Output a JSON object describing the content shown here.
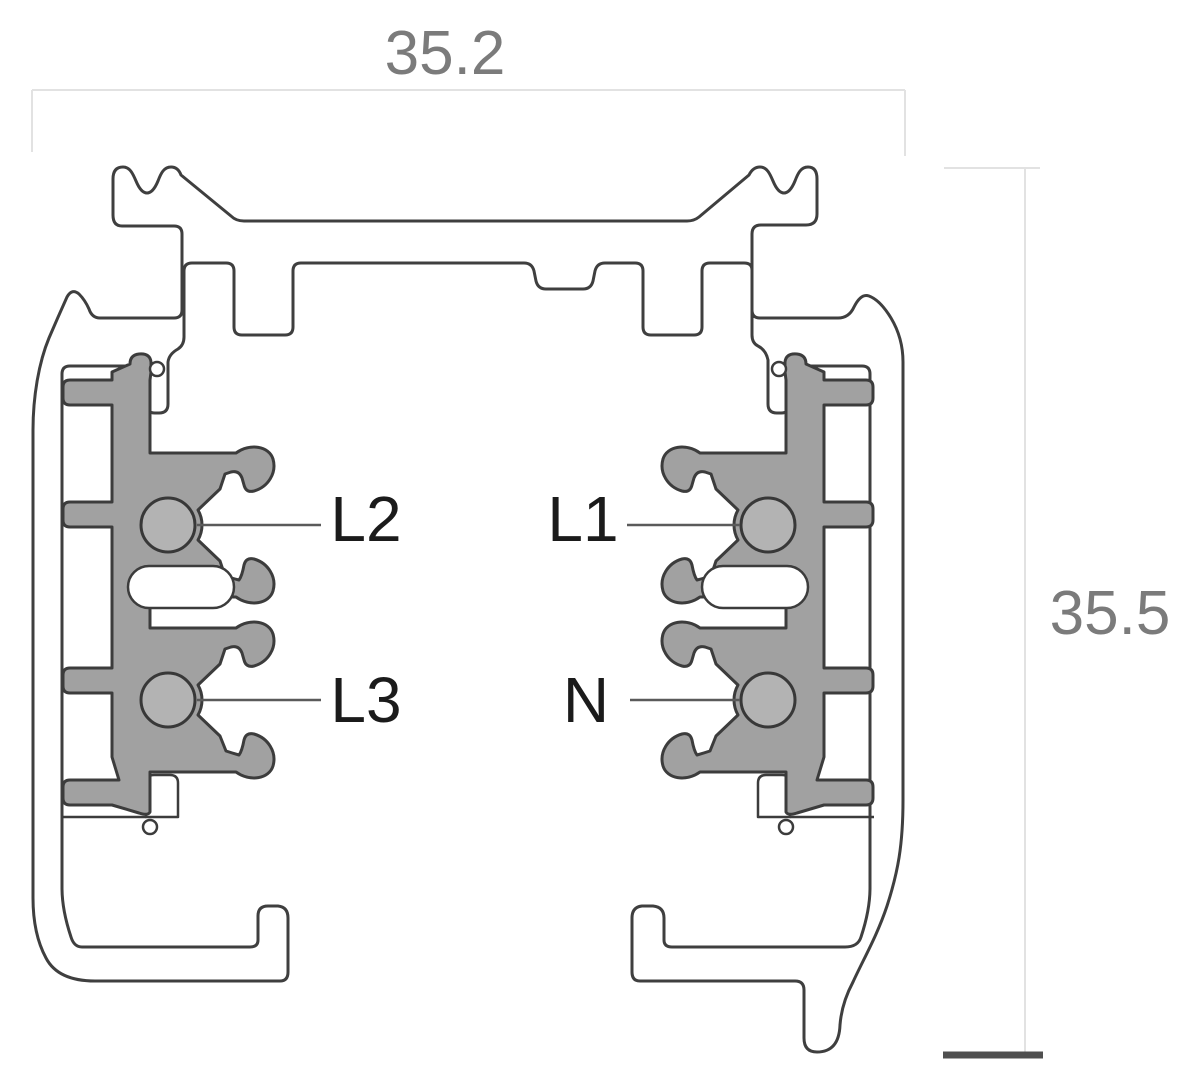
{
  "diagram": {
    "kind": "lighting-track-cross-section",
    "dimensions": {
      "width": "35.2",
      "height": "35.5"
    },
    "conductors": {
      "top_left": "L2",
      "bottom_left": "L3",
      "top_right": "L1",
      "bottom_right": "N"
    },
    "colors": {
      "background": "#ffffff",
      "outline": "#3f3f3f",
      "profile_fill": "#ffffff",
      "insert_fill": "#a1a1a1",
      "conductor_fill": "#b3b3b3",
      "label_text": "#1b1b1b",
      "dimension_text": "#7b7b7b",
      "dimension_line": "#e2e2e2",
      "leader_line": "#5a5a5a",
      "ground_bar": "#4f4f4f"
    }
  }
}
